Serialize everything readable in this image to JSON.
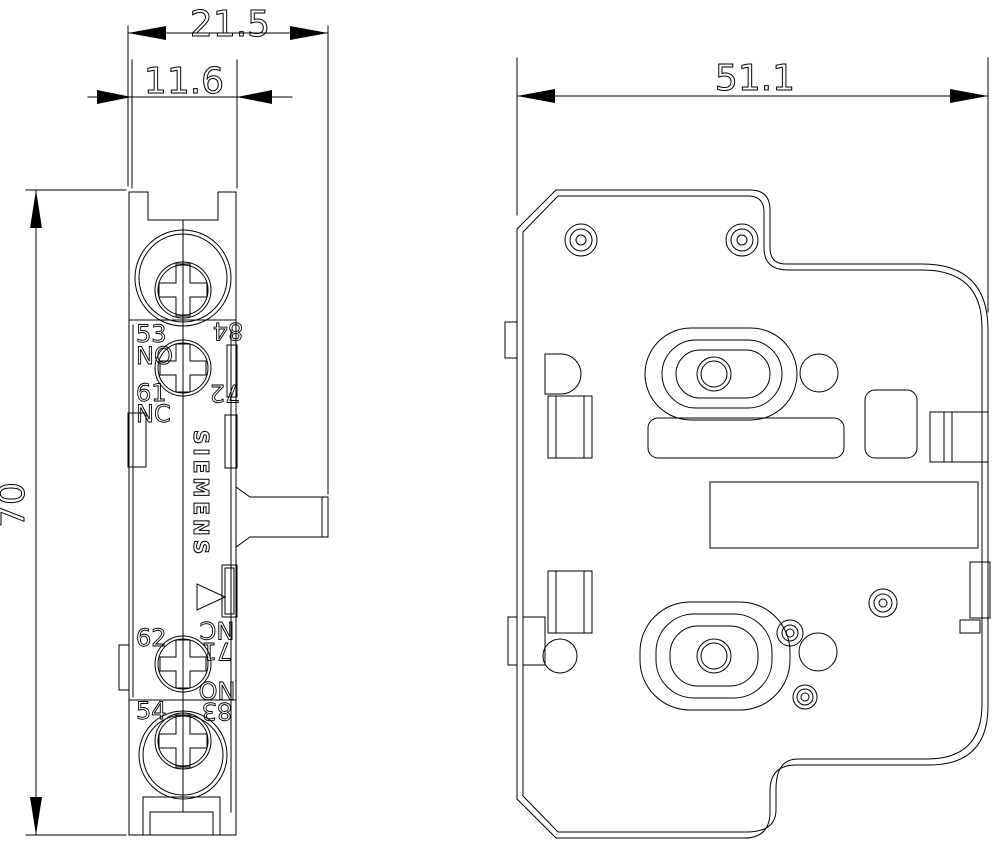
{
  "page": {
    "background": "#ffffff",
    "line_color": "#000000"
  },
  "drawing": {
    "brand_logo": "SIEMENS",
    "dimensions": {
      "total_depth_mm": "21.5",
      "body_depth_mm": "11.6",
      "front_width_mm": "51.1",
      "height_mm": "70"
    },
    "terminals": {
      "t53": "53",
      "t53_type": "NO",
      "t61": "61",
      "t61_type": "NC",
      "t62": "62",
      "t54": "54",
      "t84": "84",
      "t72": "72",
      "t71": "71",
      "t71_type": "NC",
      "t83": "83",
      "t83_type": "NO"
    }
  }
}
